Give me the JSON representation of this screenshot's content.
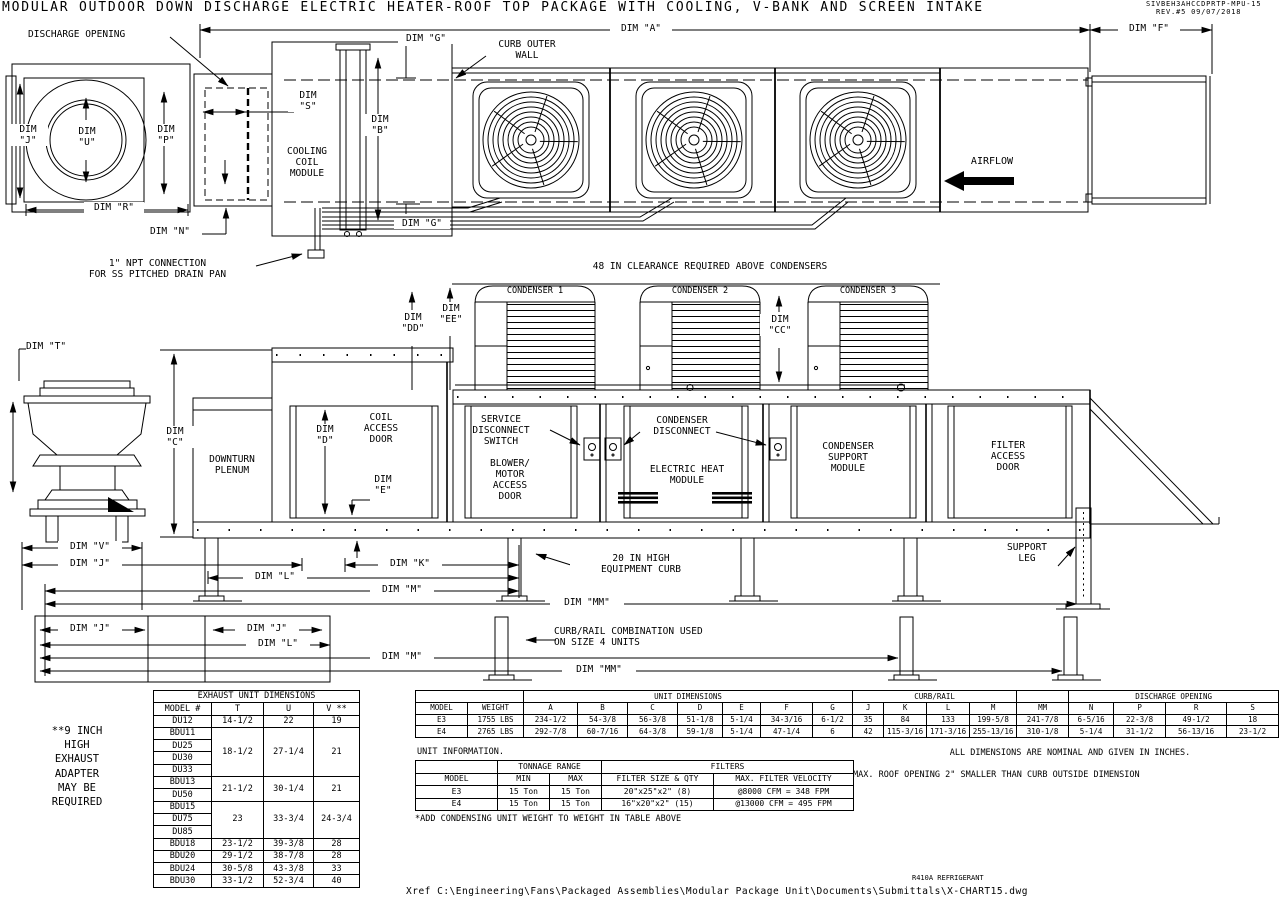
{
  "sheet": {
    "title": "MODULAR OUTDOOR DOWN DISCHARGE ELECTRIC HEATER-ROOF TOP PACKAGE WITH COOLING, V-BANK AND SCREEN INTAKE",
    "doc_number": "SIVBEH3AHCCDPRTP-MPU-15",
    "revision": "REV.#5   09/07/2018",
    "refrigerant": "R410A REFRIGERANT",
    "xref": "Xref C:\\Engineering\\Fans\\Packaged Assemblies\\Modular Package Unit\\Documents\\Submittals\\X-CHART15.dwg"
  },
  "top_view": {
    "discharge_opening": "DISCHARGE OPENING",
    "dim_a": "DIM \"A\"",
    "dim_f": "DIM \"F\"",
    "dim_g": "DIM \"G\"",
    "curb_outer_wall": "CURB OUTER\nWALL",
    "dim_j": "DIM\n\"J\"",
    "dim_u": "DIM\n\"U\"",
    "dim_p": "DIM\n\"P\"",
    "dim_s": "DIM\n\"S\"",
    "dim_b": "DIM\n\"B\"",
    "cooling_coil_module": "COOLING\nCOIL\nMODULE",
    "dim_r": "DIM \"R\"",
    "dim_n": "DIM \"N\"",
    "airflow": "AIRFLOW",
    "npt_note": "1\" NPT CONNECTION\nFOR SS PITCHED DRAIN PAN"
  },
  "condenser_view": {
    "clearance_note": "48 IN CLEARANCE REQUIRED ABOVE CONDENSERS",
    "condenser_1": "CONDENSER 1",
    "condenser_2": "CONDENSER 2",
    "condenser_3": "CONDENSER 3",
    "dim_dd": "DIM\n\"DD\"",
    "dim_ee": "DIM\n\"EE\"",
    "dim_cc": "DIM\n\"CC\""
  },
  "side_view": {
    "dim_t": "DIM \"T\"",
    "dim_c": "DIM\n\"C\"",
    "downturn_plenum": "DOWNTURN\nPLENUM",
    "dim_d": "DIM\n\"D\"",
    "dim_e": "DIM\n\"E\"",
    "coil_access_door": "COIL\nACCESS\nDOOR",
    "service_disconnect": "SERVICE\nDISCONNECT\nSWITCH",
    "blower_motor_door": "BLOWER/\nMOTOR\nACCESS\nDOOR",
    "condenser_disconnect": "CONDENSER\nDISCONNECT",
    "electric_heat_module": "ELECTRIC HEAT\nMODULE",
    "condenser_support_module": "CONDENSER\nSUPPORT\nMODULE",
    "filter_access_door": "FILTER\nACCESS\nDOOR",
    "support_leg": "SUPPORT\nLEG"
  },
  "dim_rows": {
    "dim_v": "DIM \"V\"",
    "dim_j": "DIM \"J\"",
    "dim_k": "DIM \"K\"",
    "dim_l": "DIM \"L\"",
    "dim_m": "DIM \"M\"",
    "dim_mm": "DIM \"MM\"",
    "equipment_curb_note": "20 IN HIGH\nEQUIPMENT CURB",
    "curb_rail_note": "CURB/RAIL COMBINATION USED\nON SIZE 4 UNITS"
  },
  "notes": {
    "exhaust_adapter": "**9 INCH\nHIGH\nEXHAUST\nADAPTER\nMAY BE\nREQUIRED",
    "unit_information": "UNIT INFORMATION.",
    "add_weight": "*ADD CONDENSING UNIT WEIGHT TO WEIGHT IN TABLE ABOVE",
    "nominal": "ALL DIMENSIONS ARE NOMINAL AND GIVEN IN INCHES.",
    "roof_opening": "MAX. ROOF OPENING 2\" SMALLER THAN CURB OUTSIDE DIMENSION"
  },
  "tables": {
    "exhaust": {
      "rows": [
        [
          {
            "t": "EXHAUST UNIT DIMENSIONS",
            "cs": 4
          }
        ],
        [
          "MODEL #",
          "T",
          "U",
          "V **"
        ],
        [
          "DU12",
          "14-1/2",
          "22",
          "19"
        ],
        [
          "BDU11",
          {
            "t": "18-1/2",
            "rs": 4
          },
          {
            "t": "27-1/4",
            "rs": 4
          },
          {
            "t": "21",
            "rs": 4
          }
        ],
        [
          "DU25"
        ],
        [
          "DU30"
        ],
        [
          "DU33"
        ],
        [
          "BDU13",
          {
            "t": "21-1/2",
            "rs": 2
          },
          {
            "t": "30-1/4",
            "rs": 2
          },
          {
            "t": "21",
            "rs": 2
          }
        ],
        [
          "DU50"
        ],
        [
          "BDU15",
          {
            "t": "23",
            "rs": 3
          },
          {
            "t": "33-3/4",
            "rs": 3
          },
          {
            "t": "24-3/4",
            "rs": 3
          }
        ],
        [
          "DU75"
        ],
        [
          "DU85"
        ],
        [
          "BDU18",
          "23-1/2",
          "39-3/8",
          "28"
        ],
        [
          "BDU20",
          "29-1/2",
          "38-7/8",
          "28"
        ],
        [
          "BDU24",
          "30-5/8",
          "43-3/8",
          "33"
        ],
        [
          "BDU30",
          "33-1/2",
          "52-3/4",
          "40"
        ]
      ]
    },
    "unit": {
      "rows": [
        [
          {
            "t": "",
            "cs": 2
          },
          {
            "t": "UNIT DIMENSIONS",
            "cs": 7
          },
          {
            "t": "CURB/RAIL",
            "cs": 4
          },
          {
            "t": ""
          },
          {
            "t": "DISCHARGE OPENING",
            "cs": 4
          }
        ],
        [
          "MODEL",
          "WEIGHT",
          "A",
          "B",
          "C",
          "D",
          "E",
          "F",
          "G",
          "J",
          "K",
          "L",
          "M",
          "MM",
          "N",
          "P",
          "R",
          "S"
        ],
        [
          "E3",
          "1755 LBS",
          "234-1/2",
          "54-3/8",
          "56-3/8",
          "51-1/8",
          "5-1/4",
          "34-3/16",
          "6-1/2",
          "35",
          "84",
          "133",
          "199-5/8",
          "241-7/8",
          "6-5/16",
          "22-3/8",
          "49-1/2",
          "18"
        ],
        [
          "E4",
          "2765 LBS",
          "292-7/8",
          "60-7/16",
          "64-3/8",
          "59-1/8",
          "5-1/4",
          "47-1/4",
          "6",
          "42",
          "115-3/16",
          "171-3/16",
          "255-13/16",
          "310-1/8",
          "5-1/4",
          "31-1/2",
          "56-13/16",
          "23-1/2"
        ]
      ]
    },
    "filters": {
      "rows": [
        [
          {
            "t": ""
          },
          {
            "t": "TONNAGE RANGE",
            "cs": 2
          },
          {
            "t": "FILTERS",
            "cs": 2
          }
        ],
        [
          "MODEL",
          "MIN",
          "MAX",
          "FILTER SIZE & QTY",
          "MAX. FILTER VELOCITY"
        ],
        [
          "E3",
          "15 Ton",
          "15 Ton",
          "20\"x25\"x2\" (8)",
          "@8000 CFM = 348 FPM"
        ],
        [
          "E4",
          "15 Ton",
          "15 Ton",
          "16\"x20\"x2\" (15)",
          "@13000 CFM = 495 FPM"
        ]
      ]
    }
  }
}
